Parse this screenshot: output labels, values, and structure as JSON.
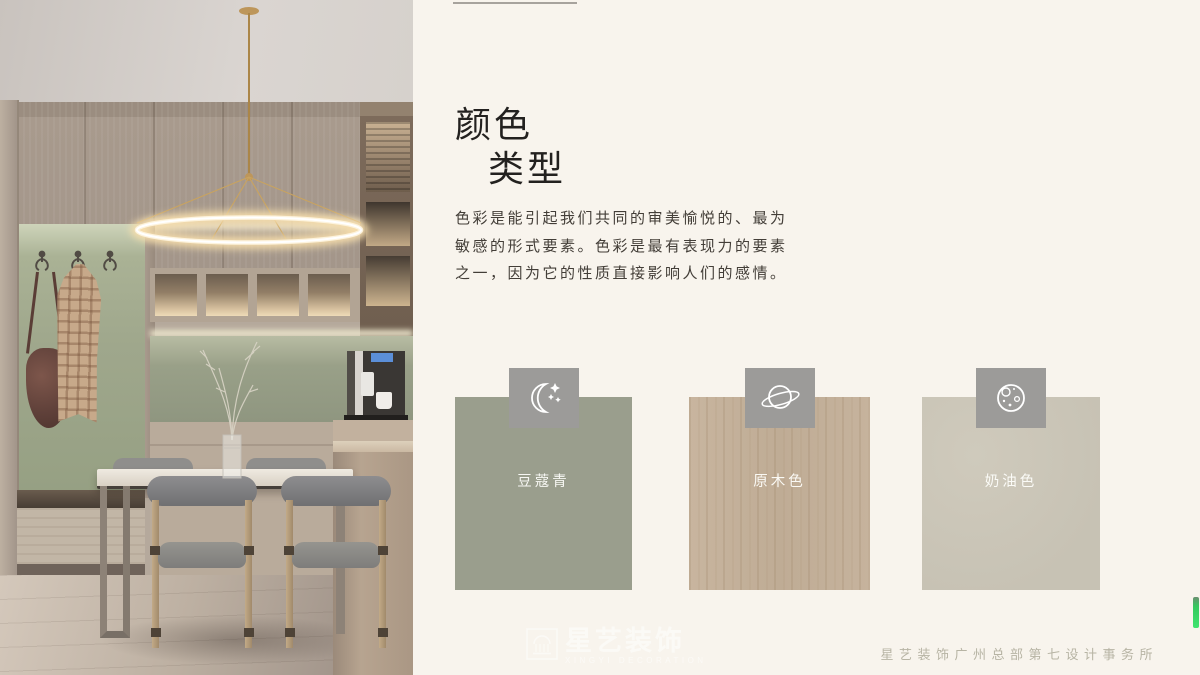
{
  "page": {
    "background_color": "#f8f4ed"
  },
  "header": {
    "title_line1": "颜色",
    "title_line2": "类型"
  },
  "intro": {
    "text": "色彩是能引起我们共同的审美愉悦的、最为敏感的形式要素。色彩是最有表现力的要素之一，因为它的性质直接影响人们的感情。"
  },
  "swatches": [
    {
      "label": "豆蔻青",
      "color": "#9a9e8d",
      "icon": "moon-stars-icon",
      "texture": "solid"
    },
    {
      "label": "原木色",
      "color": "#c3b09a",
      "icon": "planet-icon",
      "texture": "wood-grain"
    },
    {
      "label": "奶油色",
      "color": "#c9c4b6",
      "icon": "cratered-moon-icon",
      "texture": "solid"
    }
  ],
  "tile": {
    "color": "#9c9b99"
  },
  "footer": {
    "text": "星艺装饰广州总部第七设计事务所"
  },
  "watermark": {
    "brand": "星艺装饰",
    "brand_en": "XINGYI DECORATION"
  },
  "colors": {
    "title_text": "#23211f",
    "body_text": "#433e38",
    "footer_text": "#b7b4a4",
    "edge_indicator_green": "#3fe46f"
  },
  "photo": {
    "alt": "Modern dining room: gold ring pendant light, taupe wood cabinetry with lit niches, sage green wall panel with hooks holding a plaid coat and leather bag, white dining table with four gray upholstered wood chairs, dried branches in a glass vase, coffee machine on a stone counter"
  }
}
